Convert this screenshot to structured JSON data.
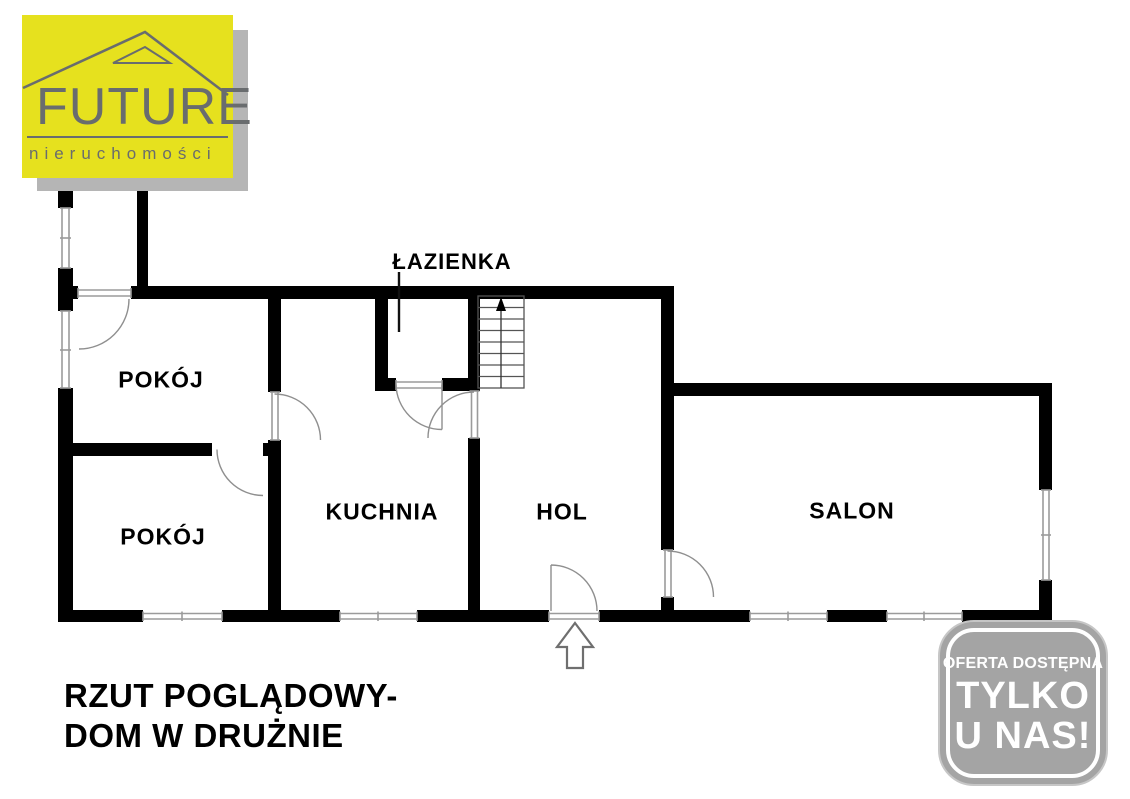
{
  "logo": {
    "brand": "FUTURE",
    "tagline": "nieruchomości",
    "colors": {
      "background": "#E6E11E",
      "ink": "#696C6E",
      "shadow": "#B5B5B5"
    }
  },
  "plan": {
    "rooms": [
      {
        "id": "bathroom",
        "label": "ŁAZIENKA"
      },
      {
        "id": "room-1",
        "label": "POKÓJ"
      },
      {
        "id": "room-2",
        "label": "POKÓJ"
      },
      {
        "id": "kitchen",
        "label": "KUCHNIA"
      },
      {
        "id": "hall",
        "label": "HOL"
      },
      {
        "id": "living-room",
        "label": "SALON"
      }
    ],
    "wall_color": "#000000",
    "opening_color": "#9B9B9B"
  },
  "caption": {
    "line1": "RZUT POGLĄDOWY-",
    "line2": "DOM W DRUŻNIE"
  },
  "badge": {
    "line1": "OFERTA DOSTĘPNA",
    "line2": "TYLKO",
    "line3": "U NAS!",
    "background": "#A4A4A4",
    "text_color": "#FFFFFF"
  }
}
